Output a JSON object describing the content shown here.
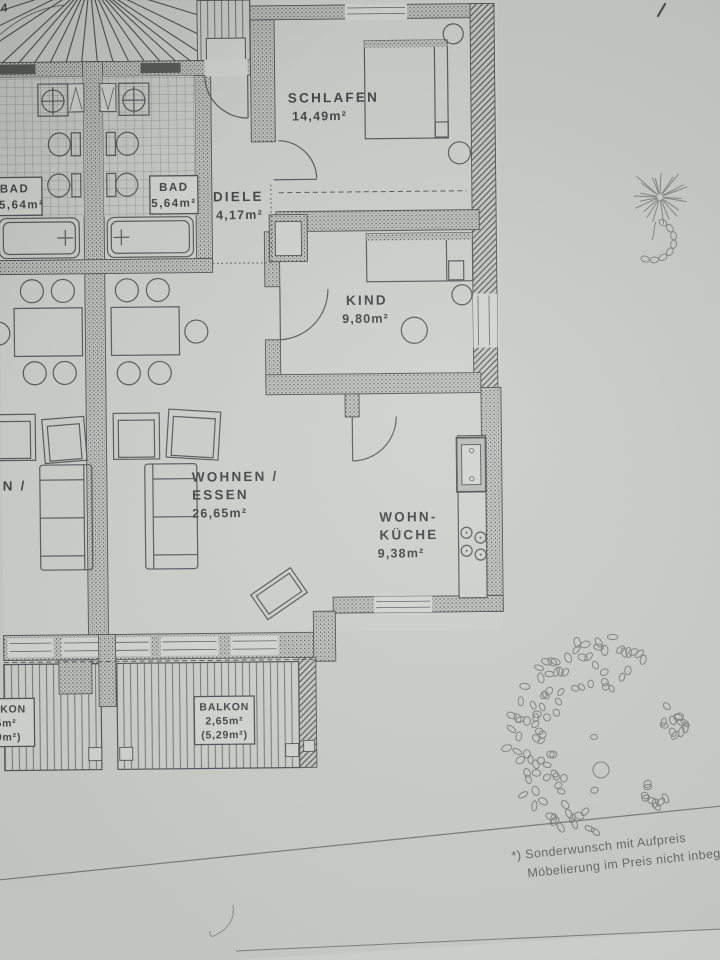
{
  "plan": {
    "stair_number": "4",
    "rooms": {
      "schlafen": {
        "name": "SCHLAFEN",
        "area": "14,49m²"
      },
      "bad_left": {
        "name": "BAD",
        "area": "5,64m²"
      },
      "bad_right": {
        "name": "BAD",
        "area": "5,64m²"
      },
      "diele": {
        "name": "DIELE",
        "area": "4,17m²"
      },
      "kind": {
        "name": "KIND",
        "area": "9,80m²"
      },
      "wohnen_essen": {
        "line1": "WOHNEN /",
        "line2": "ESSEN",
        "area": "26,65m²"
      },
      "wohnen_essen_left": {
        "line1": "WOHNEN /"
      },
      "wohnkueche": {
        "line1": "WOHN-",
        "line2": "KÜCHE",
        "area": "9,38m²"
      },
      "balkon_right": {
        "name": "BALKON",
        "area": "2,65m²",
        "area_total": "(5,29m²)"
      },
      "balkon_left": {
        "name": "BALKON",
        "area": "2,65m²",
        "area_total": "(5,29m²)"
      }
    }
  },
  "footnote": {
    "line1": "*) Sonderwunsch mit Aufpreis",
    "line2": "Möbelierung im Preis nicht inbegr"
  },
  "colors": {
    "paper": "#cbcfc9",
    "ink": "#46494b"
  }
}
